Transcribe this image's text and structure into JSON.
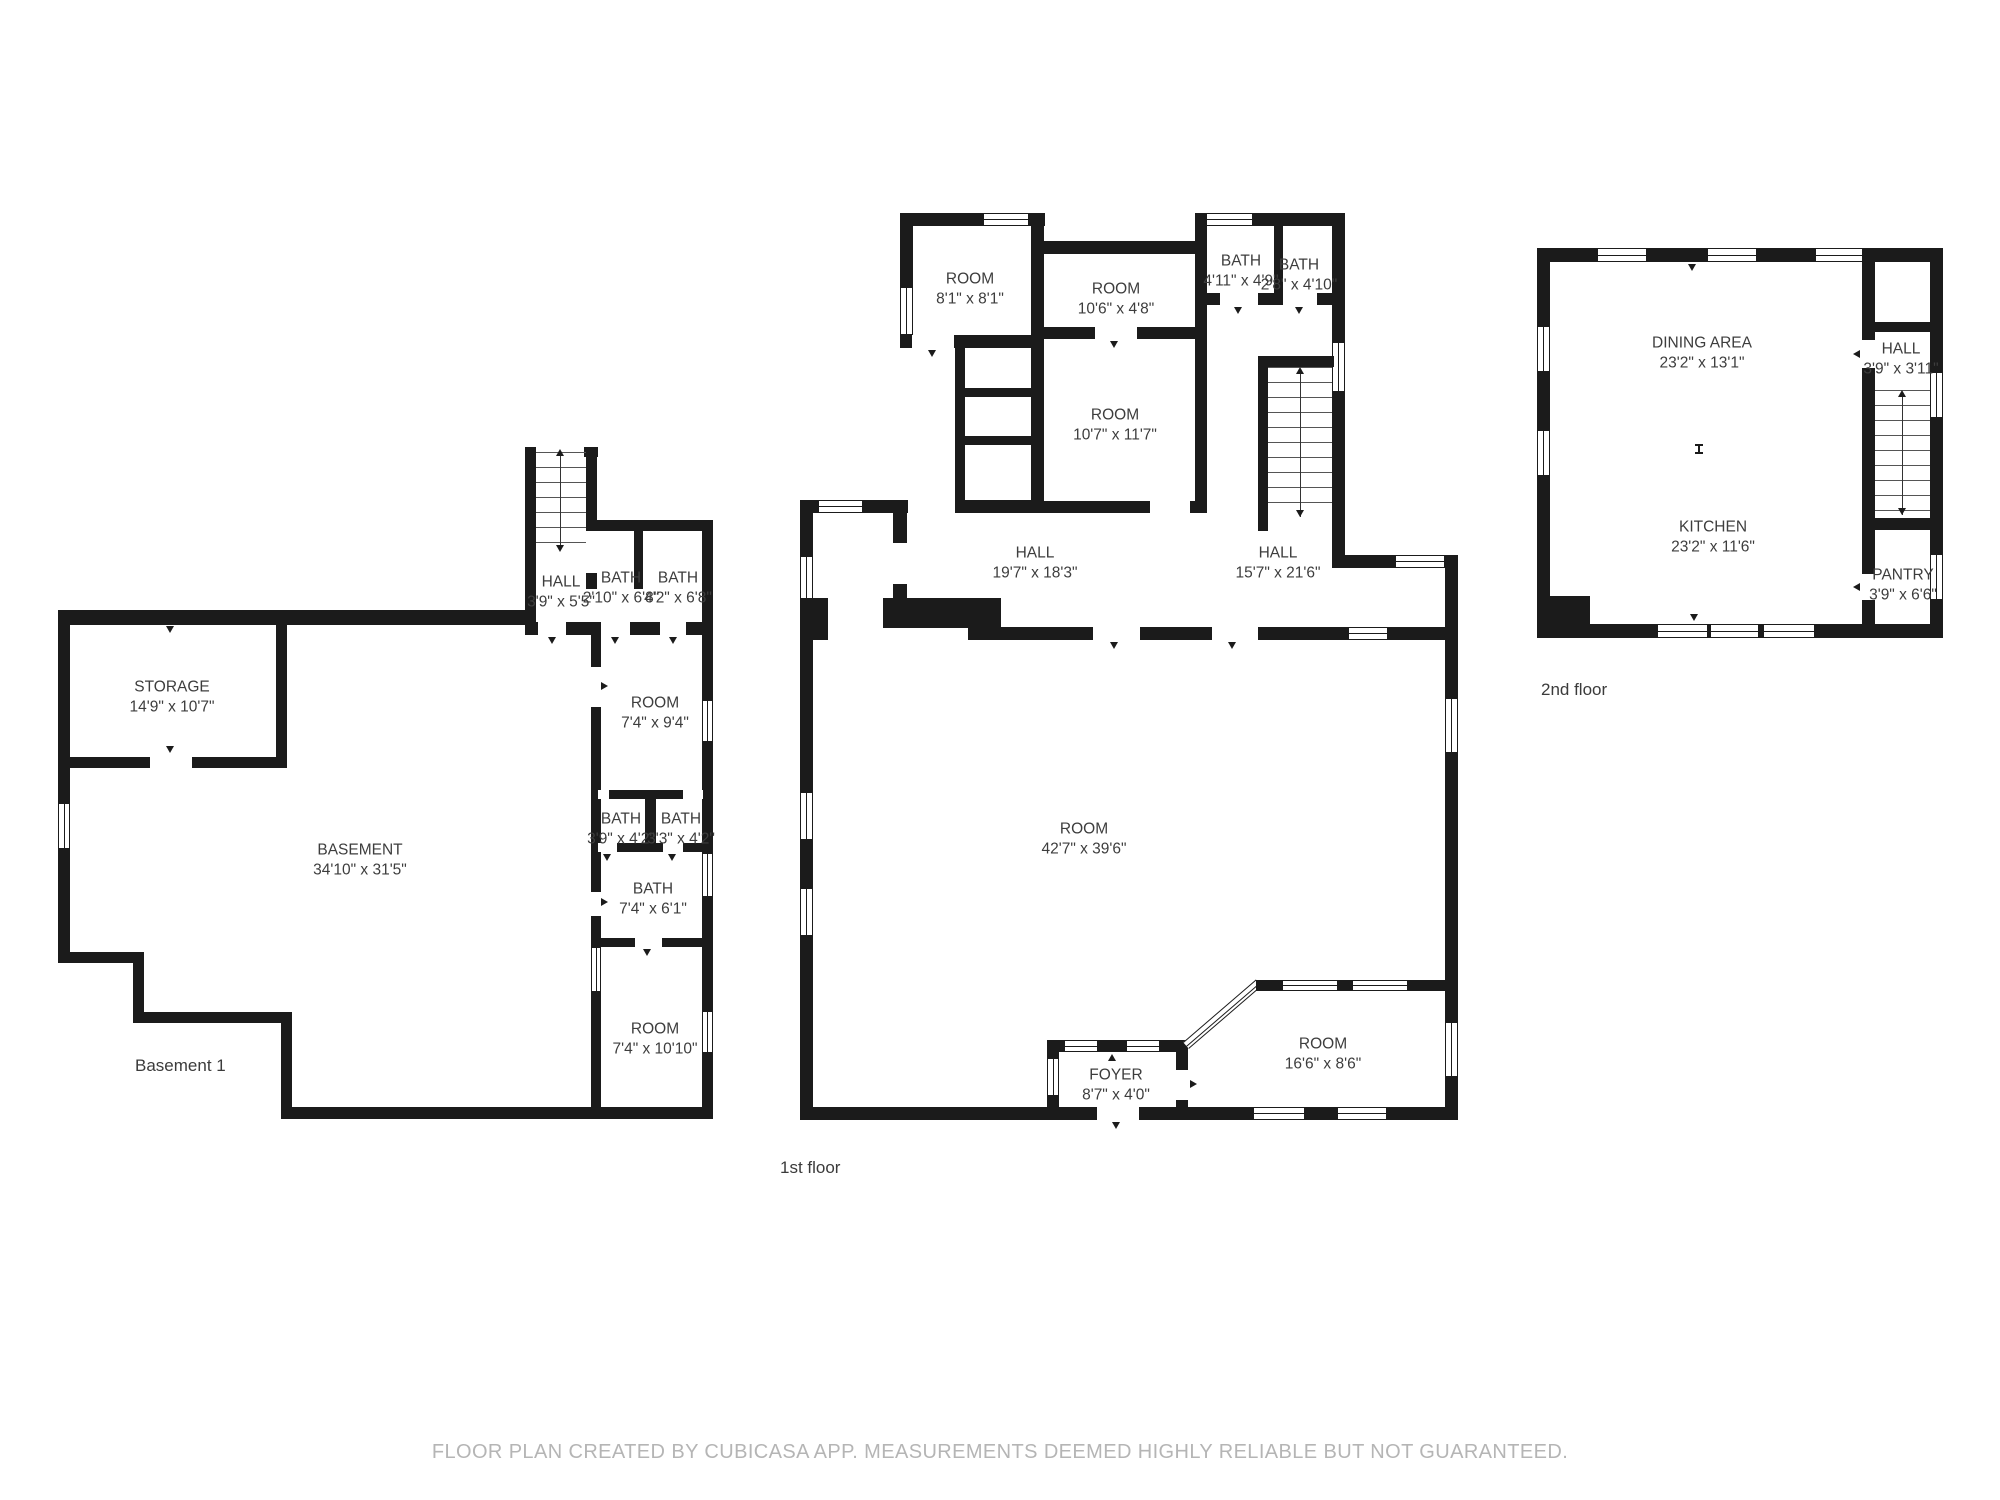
{
  "footer": {
    "disclaimer": "FLOOR PLAN CREATED BY CUBICASA APP. MEASUREMENTS DEEMED HIGHLY RELIABLE BUT NOT GUARANTEED."
  },
  "colors": {
    "wall": "#1b1b1b",
    "label_text": "#3d3d3d",
    "footer_text": "#b5b5b5",
    "background": "#ffffff"
  },
  "basement": {
    "floor_label": "Basement 1",
    "rooms": {
      "storage": {
        "name": "STORAGE",
        "dims": "14'9\" x 10'7\""
      },
      "hall": {
        "name": "HALL",
        "dims": "3'9\" x 5'5\""
      },
      "bath_top_left": {
        "name": "BATH",
        "dims": "2'10\" x 6'8\""
      },
      "bath_top_right": {
        "name": "BATH",
        "dims": "4'2\" x 6'8\""
      },
      "room_mid": {
        "name": "ROOM",
        "dims": "7'4\" x 9'4\""
      },
      "bath_a": {
        "name": "BATH",
        "dims": "3'9\" x 4'2\""
      },
      "bath_b": {
        "name": "BATH",
        "dims": "3'3\" x 4'2\""
      },
      "bath_c": {
        "name": "BATH",
        "dims": "7'4\" x 6'1\""
      },
      "room_bottom": {
        "name": "ROOM",
        "dims": "7'4\" x 10'10\""
      },
      "basement_main": {
        "name": "BASEMENT",
        "dims": "34'10\" x 31'5\""
      }
    }
  },
  "first_floor": {
    "floor_label": "1st floor",
    "rooms": {
      "room_top_left": {
        "name": "ROOM",
        "dims": "8'1\" x 8'1\""
      },
      "room_top_mid": {
        "name": "ROOM",
        "dims": "10'6\" x 4'8\""
      },
      "bath_left": {
        "name": "BATH",
        "dims": "4'11\" x 4'9\""
      },
      "bath_right": {
        "name": "BATH",
        "dims": "2'8\" x 4'10\""
      },
      "room_mid": {
        "name": "ROOM",
        "dims": "10'7\" x 11'7\""
      },
      "hall_left": {
        "name": "HALL",
        "dims": "19'7\" x 18'3\""
      },
      "hall_right": {
        "name": "HALL",
        "dims": "15'7\" x 21'6\""
      },
      "room_main": {
        "name": "ROOM",
        "dims": "42'7\" x 39'6\""
      },
      "room_bottom_right": {
        "name": "ROOM",
        "dims": "16'6\" x 8'6\""
      },
      "foyer": {
        "name": "FOYER",
        "dims": "8'7\" x 4'0\""
      }
    }
  },
  "second_floor": {
    "floor_label": "2nd floor",
    "rooms": {
      "dining": {
        "name": "DINING AREA",
        "dims": "23'2\" x 13'1\""
      },
      "kitchen": {
        "name": "KITCHEN",
        "dims": "23'2\" x 11'6\""
      },
      "hall": {
        "name": "HALL",
        "dims": "3'9\" x 3'11\""
      },
      "pantry": {
        "name": "PANTRY",
        "dims": "3'9\" x 6'6\""
      }
    }
  }
}
